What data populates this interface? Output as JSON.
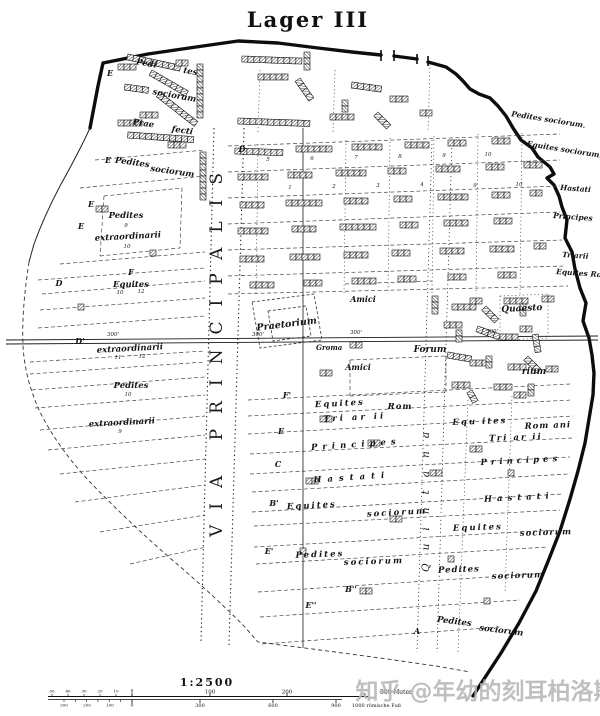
{
  "title": "Lager III",
  "watermark": "知乎 @年幼的刻耳柏洛斯",
  "roads": {
    "via_principalis": "VIA PRINCIPALIS",
    "via_quintana": "Quintana",
    "groma": "Groma"
  },
  "scalebar": {
    "ratio": "1:2500",
    "top_numbers": [
      {
        "t": "100",
        "x": 210
      },
      {
        "t": "200",
        "x": 287
      }
    ],
    "top_unit": "300 Meter",
    "top_minor": [
      {
        "t": "50",
        "x": 52
      },
      {
        "t": "40",
        "x": 68
      },
      {
        "t": "30",
        "x": 84
      },
      {
        "t": "20",
        "x": 100
      },
      {
        "t": "10",
        "x": 116
      }
    ],
    "zero": "0",
    "bottom_numbers": [
      {
        "t": "300",
        "x": 200
      },
      {
        "t": "600",
        "x": 273
      },
      {
        "t": "900",
        "x": 336
      }
    ],
    "bottom_minor": [
      {
        "t": "300",
        "x": 64
      },
      {
        "t": "200",
        "x": 87
      },
      {
        "t": "100",
        "x": 110
      }
    ],
    "bottom_unit": "1000 römische Fuß"
  },
  "labels": [
    {
      "t": "Pedi",
      "x": 146,
      "y": 66,
      "rot": 10
    },
    {
      "t": "tes",
      "x": 190,
      "y": 74,
      "rot": 10
    },
    {
      "t": "sociorum",
      "x": 174,
      "y": 98,
      "rot": 10
    },
    {
      "t": "Prae",
      "x": 143,
      "y": 126,
      "rot": 8
    },
    {
      "t": "fecti",
      "x": 182,
      "y": 133,
      "rot": 8
    },
    {
      "t": "Pedites",
      "x": 132,
      "y": 165,
      "rot": 8
    },
    {
      "t": "sociorum",
      "x": 172,
      "y": 174,
      "rot": 8
    },
    {
      "t": "Pedites",
      "x": 126,
      "y": 218
    },
    {
      "t": "extraordinarii",
      "x": 128,
      "y": 239,
      "rot": -3
    },
    {
      "t": "Equites",
      "x": 131,
      "y": 287
    },
    {
      "t": "extraordinarii",
      "x": 130,
      "y": 351,
      "rot": -3
    },
    {
      "t": "Pedites",
      "x": 131,
      "y": 388
    },
    {
      "t": "extraordinarii",
      "x": 122,
      "y": 425,
      "rot": -3
    },
    {
      "t": "Praetorium",
      "x": 287,
      "y": 327,
      "rot": -7,
      "fs": 9.5
    },
    {
      "t": "Amici",
      "x": 363,
      "y": 302,
      "fs": 8
    },
    {
      "t": "Amici",
      "x": 358,
      "y": 370,
      "fs": 8
    },
    {
      "t": "Forum",
      "x": 430,
      "y": 352,
      "fs": 9
    },
    {
      "t": "Quaesto",
      "x": 522,
      "y": 311,
      "fs": 9,
      "rot": -3
    },
    {
      "t": "rium",
      "x": 534,
      "y": 374,
      "fs": 9
    },
    {
      "t": "Pedites sociorum.",
      "x": 548,
      "y": 122,
      "rot": 9,
      "fs": 7.5
    },
    {
      "t": "Equites sociorum.",
      "x": 564,
      "y": 152,
      "rot": 9,
      "fs": 7.5
    },
    {
      "t": "Hastati",
      "x": 560,
      "y": 190,
      "a": "s",
      "fs": 7.5,
      "rot": 4
    },
    {
      "t": "Principes",
      "x": 553,
      "y": 218,
      "a": "s",
      "fs": 7.5,
      "rot": 4
    },
    {
      "t": "Triarii",
      "x": 562,
      "y": 257,
      "a": "s",
      "fs": 7.5,
      "rot": 4
    },
    {
      "t": "Equites Rom.",
      "x": 556,
      "y": 274,
      "a": "s",
      "fs": 7.5,
      "rot": 4
    },
    {
      "t": "Equites",
      "x": 340,
      "y": 406,
      "ls": 2,
      "rot": -3
    },
    {
      "t": "Rom",
      "x": 400,
      "y": 409,
      "ls": 1
    },
    {
      "t": "Tri ar ii",
      "x": 355,
      "y": 420,
      "ls": 3,
      "rot": -3
    },
    {
      "t": "Principes",
      "x": 356,
      "y": 447,
      "ls": 5,
      "rot": -4
    },
    {
      "t": "Hastati",
      "x": 352,
      "y": 480,
      "ls": 6,
      "rot": -4
    },
    {
      "t": "Equites",
      "x": 312,
      "y": 508,
      "ls": 2,
      "rot": -3
    },
    {
      "t": "sociorum",
      "x": 397,
      "y": 515,
      "ls": 2,
      "rot": -3
    },
    {
      "t": "Pedites",
      "x": 320,
      "y": 557,
      "ls": 2,
      "rot": -2
    },
    {
      "t": "sociorum",
      "x": 374,
      "y": 564,
      "ls": 2,
      "rot": -2
    },
    {
      "t": "Equ ites",
      "x": 480,
      "y": 424,
      "ls": 2,
      "rot": -2
    },
    {
      "t": "Rom ani",
      "x": 548,
      "y": 428,
      "ls": 1,
      "rot": -2
    },
    {
      "t": "Tri ar ii",
      "x": 516,
      "y": 440,
      "ls": 2,
      "rot": -2
    },
    {
      "t": "Principes",
      "x": 521,
      "y": 463,
      "ls": 4,
      "rot": -3
    },
    {
      "t": "Hastati",
      "x": 519,
      "y": 500,
      "ls": 5,
      "rot": -3
    },
    {
      "t": "Equites",
      "x": 478,
      "y": 530,
      "ls": 2,
      "rot": -2
    },
    {
      "t": "sociorum",
      "x": 546,
      "y": 535,
      "ls": 1,
      "rot": -2
    },
    {
      "t": "Pedites",
      "x": 459,
      "y": 572,
      "ls": 1,
      "rot": -2
    },
    {
      "t": "sociorum",
      "x": 518,
      "y": 578,
      "ls": 1,
      "rot": -2
    },
    {
      "t": "Pedites",
      "x": 454,
      "y": 624,
      "rot": 7
    },
    {
      "t": "sociorum",
      "x": 501,
      "y": 633,
      "rot": 7
    }
  ],
  "markers": [
    {
      "t": "E",
      "x": 110,
      "y": 76
    },
    {
      "t": "E",
      "x": 108,
      "y": 163
    },
    {
      "t": "E",
      "x": 91,
      "y": 207
    },
    {
      "t": "E",
      "x": 81,
      "y": 229
    },
    {
      "t": "D",
      "x": 242,
      "y": 152
    },
    {
      "t": "D",
      "x": 59,
      "y": 286
    },
    {
      "t": "F",
      "x": 131,
      "y": 275
    },
    {
      "t": "D'",
      "x": 80,
      "y": 344
    },
    {
      "t": "F'",
      "x": 287,
      "y": 398
    },
    {
      "t": "E",
      "x": 281,
      "y": 434
    },
    {
      "t": "C",
      "x": 278,
      "y": 467
    },
    {
      "t": "B'",
      "x": 274,
      "y": 506
    },
    {
      "t": "E'",
      "x": 269,
      "y": 554
    },
    {
      "t": "B''",
      "x": 351,
      "y": 592
    },
    {
      "t": "E''",
      "x": 311,
      "y": 608
    },
    {
      "t": "A",
      "x": 417,
      "y": 634
    }
  ],
  "numbers": [
    {
      "t": "9",
      "x": 126,
      "y": 227
    },
    {
      "t": "10",
      "x": 127,
      "y": 248
    },
    {
      "t": "10",
      "x": 120,
      "y": 294
    },
    {
      "t": "12",
      "x": 141,
      "y": 293
    },
    {
      "t": "11",
      "x": 118,
      "y": 359
    },
    {
      "t": "12",
      "x": 142,
      "y": 358
    },
    {
      "t": "10",
      "x": 128,
      "y": 396
    },
    {
      "t": "9",
      "x": 120,
      "y": 433
    },
    {
      "t": "5",
      "x": 268,
      "y": 161
    },
    {
      "t": "6",
      "x": 312,
      "y": 160
    },
    {
      "t": "7",
      "x": 356,
      "y": 159
    },
    {
      "t": "8",
      "x": 400,
      "y": 158
    },
    {
      "t": "9",
      "x": 444,
      "y": 157
    },
    {
      "t": "10",
      "x": 488,
      "y": 156
    },
    {
      "t": "1",
      "x": 290,
      "y": 189
    },
    {
      "t": "2",
      "x": 334,
      "y": 188
    },
    {
      "t": "3",
      "x": 378,
      "y": 187
    },
    {
      "t": "4",
      "x": 422,
      "y": 186
    },
    {
      "t": "9",
      "x": 475,
      "y": 187
    },
    {
      "t": "10",
      "x": 519,
      "y": 186
    },
    {
      "t": "300'",
      "x": 113,
      "y": 336
    },
    {
      "t": "300'",
      "x": 258,
      "y": 336
    },
    {
      "t": "300'",
      "x": 356,
      "y": 334
    },
    {
      "t": "300'",
      "x": 492,
      "y": 333
    }
  ]
}
